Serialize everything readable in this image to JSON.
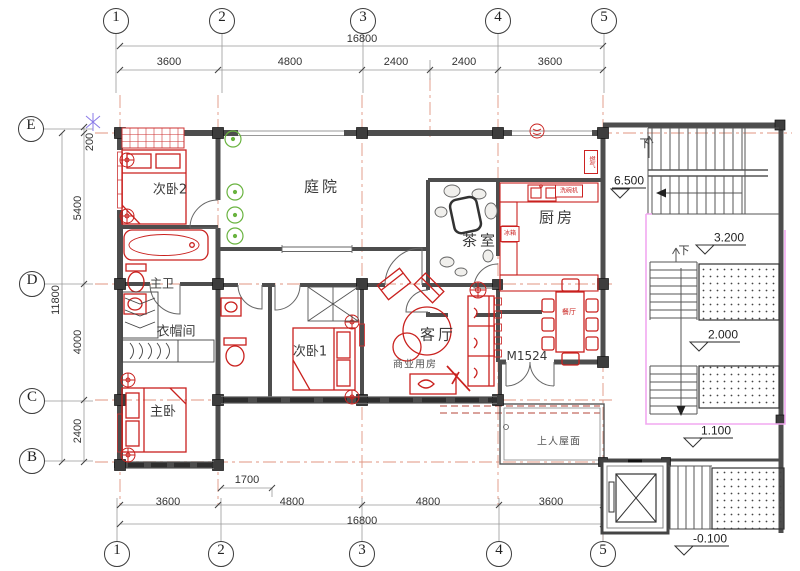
{
  "axes": {
    "top": [
      "1",
      "2",
      "3",
      "4",
      "5"
    ],
    "bottom": [
      "1",
      "2",
      "3",
      "4",
      "5"
    ],
    "left": [
      "E",
      "D",
      "C",
      "B"
    ]
  },
  "dims": {
    "top_total": "16800",
    "top_seg": [
      "3600",
      "4800",
      "2400",
      "2400",
      "3600"
    ],
    "left_total": "11800",
    "left_seg": [
      "200",
      "5400",
      "4000",
      "2400"
    ],
    "bottom_seg": [
      "3600",
      "4800",
      "4800",
      "3600"
    ],
    "bottom_total": "16800",
    "offset": "1700"
  },
  "rooms": {
    "bedroom2": "次卧2",
    "courtyard": "庭院",
    "tea": "茶室",
    "kitchen": "厨房",
    "master_bath": "主卫",
    "cloak": "衣帽间",
    "bedroom1": "次卧1",
    "living": "客厅",
    "commercial": "商业用房",
    "dining": "餐厅",
    "master_bed": "主卧",
    "roof": "上人屋面"
  },
  "marks": {
    "door": "M1524",
    "down_upper": "下",
    "down_lower": "下",
    "level_top": "6.500",
    "level_mid": "3.200",
    "level_low": "2.000",
    "level_entry": "1.100",
    "level_ground": "-0.100",
    "tag_dishwasher": "洗碗机",
    "tag_fridge": "冰箱",
    "tag_meter": "燃气"
  },
  "colors": {
    "wall": "#4d4d4d",
    "furniture": "#c9211e",
    "axis_line": "#e09582",
    "plant": "#69b33f",
    "highlight": "#f2a8f0"
  }
}
